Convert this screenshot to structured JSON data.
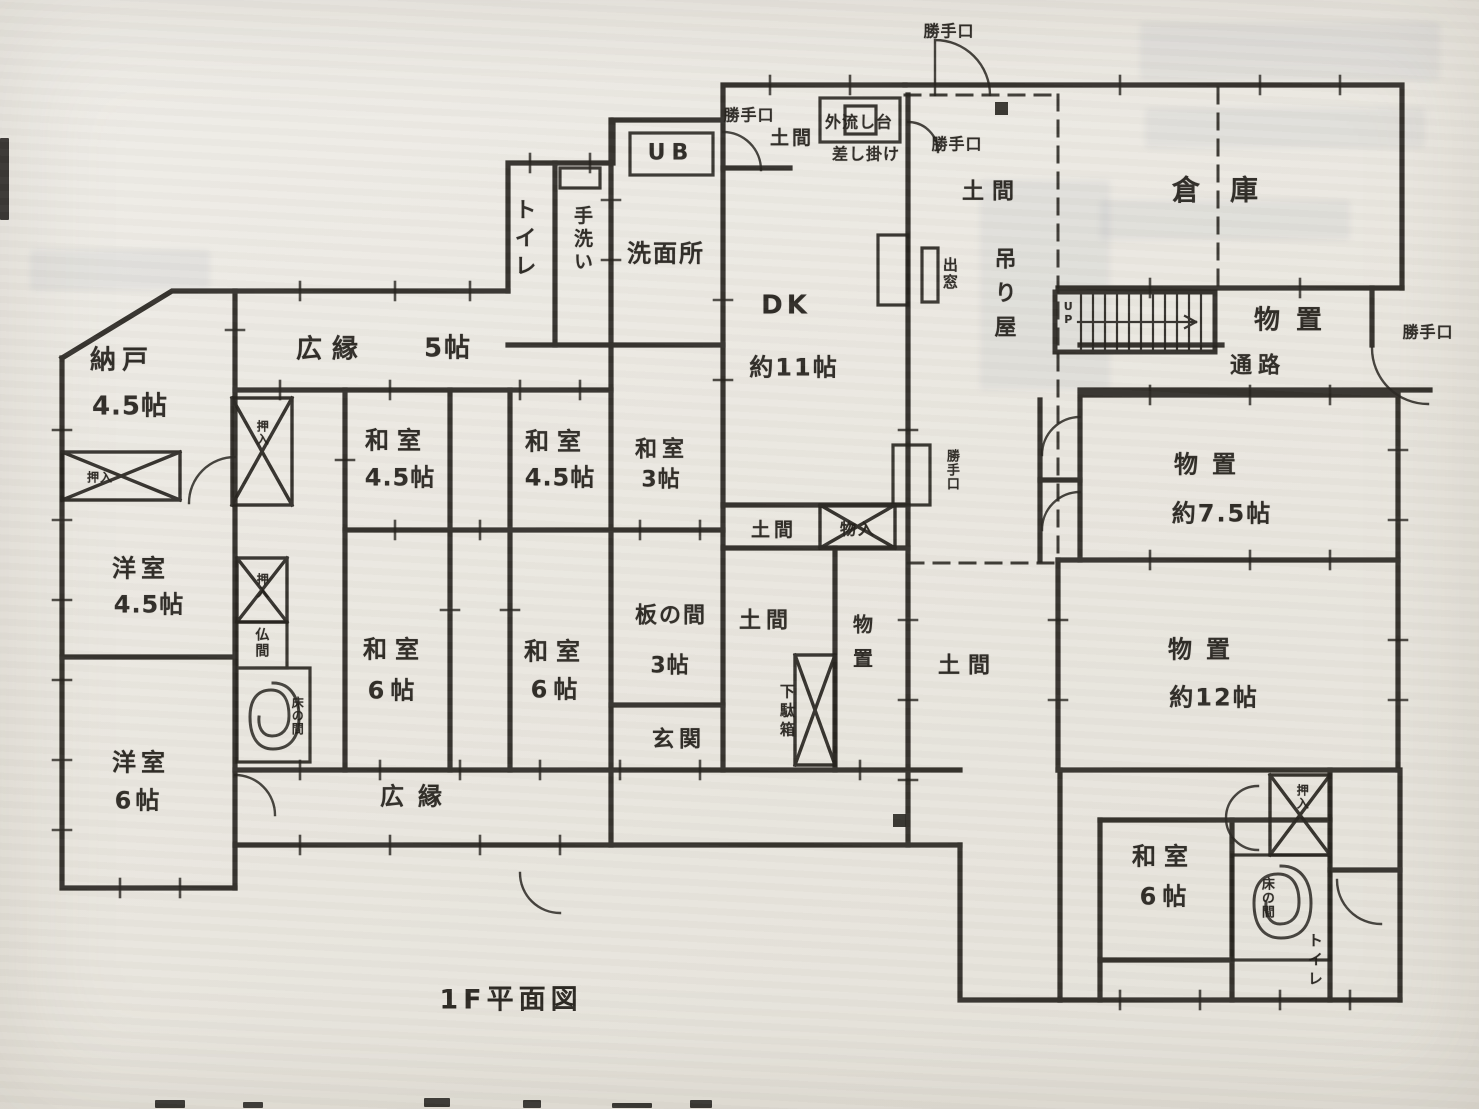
{
  "document": {
    "plan_title": "1F平面図"
  },
  "palette": {
    "paper": "#eae7e0",
    "ink": "#26231e"
  },
  "stairs": {
    "direction_label": "UP"
  },
  "labels": [
    {
      "name": "nando",
      "text": "納戸",
      "x": 122,
      "y": 361,
      "fs": 26,
      "o": "h",
      "ls": 6
    },
    {
      "name": "nando-size",
      "text": "4.5帖",
      "x": 130,
      "y": 407,
      "fs": 26,
      "o": "h",
      "ls": 1
    },
    {
      "name": "hiroen-top",
      "text": "広縁",
      "x": 332,
      "y": 350,
      "fs": 26,
      "o": "h",
      "ls": 10
    },
    {
      "name": "hiroen-top-size",
      "text": "5帖",
      "x": 448,
      "y": 349,
      "fs": 26,
      "o": "h",
      "ls": 2
    },
    {
      "name": "toilet-1",
      "text": "トイレ",
      "x": 523,
      "y": 240,
      "fs": 22,
      "o": "v",
      "ls": 6
    },
    {
      "name": "tearai",
      "text": "手洗い",
      "x": 581,
      "y": 240,
      "fs": 19,
      "o": "v",
      "ls": 4
    },
    {
      "name": "ub",
      "text": "UB",
      "x": 671,
      "y": 153,
      "fs": 22,
      "o": "h",
      "ls": 6
    },
    {
      "name": "senmenjo",
      "text": "洗面所",
      "x": 666,
      "y": 254,
      "fs": 24,
      "o": "h",
      "ls": 2
    },
    {
      "name": "katteguchi-1",
      "text": "勝手口",
      "x": 749,
      "y": 116,
      "fs": 16,
      "o": "h",
      "ls": 1
    },
    {
      "name": "doma-kitchen",
      "text": "土間",
      "x": 792,
      "y": 139,
      "fs": 19,
      "o": "h",
      "ls": 3
    },
    {
      "name": "sotonagashidai",
      "text": "外流し台",
      "x": 859,
      "y": 123,
      "fs": 16,
      "o": "h",
      "ls": 1
    },
    {
      "name": "sashikake",
      "text": "差し掛け",
      "x": 866,
      "y": 155,
      "fs": 16,
      "o": "h",
      "ls": 1
    },
    {
      "name": "katteguchi-2",
      "text": "勝手口",
      "x": 949,
      "y": 32,
      "fs": 16,
      "o": "h",
      "ls": 1
    },
    {
      "name": "katteguchi-3",
      "text": "勝手口",
      "x": 957,
      "y": 145,
      "fs": 16,
      "o": "h",
      "ls": 1
    },
    {
      "name": "doma-top",
      "text": "土間",
      "x": 992,
      "y": 192,
      "fs": 22,
      "o": "h",
      "ls": 8
    },
    {
      "name": "tsuriya",
      "text": "吊り屋",
      "x": 1003,
      "y": 298,
      "fs": 22,
      "o": "v",
      "ls": 12
    },
    {
      "name": "demado",
      "text": "出窓",
      "x": 949,
      "y": 274,
      "fs": 15,
      "o": "v",
      "ls": 2
    },
    {
      "name": "dk",
      "text": "DK",
      "x": 786,
      "y": 306,
      "fs": 26,
      "o": "h",
      "ls": 4
    },
    {
      "name": "dk-size",
      "text": "約11帖",
      "x": 794,
      "y": 368,
      "fs": 24,
      "o": "h",
      "ls": 2
    },
    {
      "name": "souko",
      "text": "倉庫",
      "x": 1230,
      "y": 190,
      "fs": 28,
      "o": "h",
      "ls": 30
    },
    {
      "name": "monooki-1",
      "text": "物置",
      "x": 1296,
      "y": 321,
      "fs": 26,
      "o": "h",
      "ls": 16
    },
    {
      "name": "tsuuro",
      "text": "通路",
      "x": 1258,
      "y": 366,
      "fs": 22,
      "o": "h",
      "ls": 6
    },
    {
      "name": "katteguchi-4",
      "text": "勝手口",
      "x": 1428,
      "y": 333,
      "fs": 16,
      "o": "h",
      "ls": 1
    },
    {
      "name": "monooki-2",
      "text": "物置",
      "x": 1212,
      "y": 465,
      "fs": 24,
      "o": "h",
      "ls": 14
    },
    {
      "name": "monooki-2-size",
      "text": "約7.5帖",
      "x": 1222,
      "y": 514,
      "fs": 24,
      "o": "h",
      "ls": 2
    },
    {
      "name": "washitsu-1",
      "text": "和室",
      "x": 397,
      "y": 441,
      "fs": 24,
      "o": "h",
      "ls": 8
    },
    {
      "name": "washitsu-1-size",
      "text": "4.5帖",
      "x": 400,
      "y": 478,
      "fs": 24,
      "o": "h",
      "ls": 1
    },
    {
      "name": "washitsu-2",
      "text": "和室",
      "x": 557,
      "y": 442,
      "fs": 24,
      "o": "h",
      "ls": 8
    },
    {
      "name": "washitsu-2-size",
      "text": "4.5帖",
      "x": 560,
      "y": 478,
      "fs": 24,
      "o": "h",
      "ls": 1
    },
    {
      "name": "washitsu-3",
      "text": "和室",
      "x": 662,
      "y": 450,
      "fs": 22,
      "o": "h",
      "ls": 5
    },
    {
      "name": "washitsu-3-size",
      "text": "3帖",
      "x": 661,
      "y": 480,
      "fs": 22,
      "o": "h",
      "ls": 1
    },
    {
      "name": "doma-center-1",
      "text": "土間",
      "x": 774,
      "y": 531,
      "fs": 19,
      "o": "h",
      "ls": 4
    },
    {
      "name": "monoire",
      "text": "物入",
      "x": 858,
      "y": 530,
      "fs": 16,
      "o": "h",
      "ls": 2
    },
    {
      "name": "doma-center-2",
      "text": "土間",
      "x": 766,
      "y": 621,
      "fs": 22,
      "o": "h",
      "ls": 5
    },
    {
      "name": "monooki-column",
      "text": "物置",
      "x": 861,
      "y": 648,
      "fs": 20,
      "o": "v",
      "ls": 14
    },
    {
      "name": "getabako",
      "text": "下駄箱",
      "x": 786,
      "y": 712,
      "fs": 15,
      "o": "v",
      "ls": 4
    },
    {
      "name": "doma-center-3",
      "text": "土間",
      "x": 968,
      "y": 666,
      "fs": 22,
      "o": "h",
      "ls": 8
    },
    {
      "name": "itanoma",
      "text": "板の間",
      "x": 671,
      "y": 616,
      "fs": 22,
      "o": "h",
      "ls": 2
    },
    {
      "name": "itanoma-size",
      "text": "3帖",
      "x": 670,
      "y": 666,
      "fs": 22,
      "o": "h",
      "ls": 1
    },
    {
      "name": "genkan",
      "text": "玄関",
      "x": 679,
      "y": 740,
      "fs": 22,
      "o": "h",
      "ls": 5
    },
    {
      "name": "washitsu-4",
      "text": "和室",
      "x": 395,
      "y": 650,
      "fs": 24,
      "o": "h",
      "ls": 8
    },
    {
      "name": "washitsu-4-size",
      "text": "6帖",
      "x": 394,
      "y": 691,
      "fs": 24,
      "o": "h",
      "ls": 6
    },
    {
      "name": "washitsu-5",
      "text": "和室",
      "x": 556,
      "y": 652,
      "fs": 24,
      "o": "h",
      "ls": 8
    },
    {
      "name": "washitsu-5-size",
      "text": "6帖",
      "x": 557,
      "y": 690,
      "fs": 24,
      "o": "h",
      "ls": 6
    },
    {
      "name": "youshitsu-1",
      "text": "洋室",
      "x": 141,
      "y": 569,
      "fs": 24,
      "o": "h",
      "ls": 5
    },
    {
      "name": "youshitsu-1-size",
      "text": "4.5帖",
      "x": 149,
      "y": 605,
      "fs": 24,
      "o": "h",
      "ls": 1
    },
    {
      "name": "youshitsu-2",
      "text": "洋室",
      "x": 141,
      "y": 763,
      "fs": 24,
      "o": "h",
      "ls": 5
    },
    {
      "name": "youshitsu-2-size",
      "text": "6帖",
      "x": 139,
      "y": 801,
      "fs": 24,
      "o": "h",
      "ls": 4
    },
    {
      "name": "hiroen-bottom",
      "text": "広縁",
      "x": 418,
      "y": 797,
      "fs": 24,
      "o": "h",
      "ls": 14
    },
    {
      "name": "monooki-3",
      "text": "物置",
      "x": 1206,
      "y": 650,
      "fs": 24,
      "o": "h",
      "ls": 14
    },
    {
      "name": "monooki-3-size",
      "text": "約12帖",
      "x": 1214,
      "y": 698,
      "fs": 24,
      "o": "h",
      "ls": 2
    },
    {
      "name": "washitsu-6",
      "text": "和室",
      "x": 1164,
      "y": 857,
      "fs": 24,
      "o": "h",
      "ls": 8
    },
    {
      "name": "washitsu-6-size",
      "text": "6帖",
      "x": 1166,
      "y": 897,
      "fs": 24,
      "o": "h",
      "ls": 6
    },
    {
      "name": "tokonoma-2",
      "text": "床の間",
      "x": 1266,
      "y": 898,
      "fs": 13,
      "o": "v",
      "ls": 1
    },
    {
      "name": "oshiire-4",
      "text": "押入",
      "x": 1302,
      "y": 797,
      "fs": 12,
      "o": "v",
      "ls": 1
    },
    {
      "name": "toilet-2",
      "text": "トイレ",
      "x": 1314,
      "y": 961,
      "fs": 15,
      "o": "v",
      "ls": 4
    },
    {
      "name": "oshiire-1",
      "text": "押入",
      "x": 262,
      "y": 433,
      "fs": 12,
      "o": "v",
      "ls": 1
    },
    {
      "name": "oshiire-2",
      "text": "押入",
      "x": 100,
      "y": 478,
      "fs": 12,
      "o": "h",
      "ls": 1
    },
    {
      "name": "oshiire-3",
      "text": "押入",
      "x": 262,
      "y": 586,
      "fs": 12,
      "o": "v",
      "ls": 1
    },
    {
      "name": "butsuma",
      "text": "仏間",
      "x": 261,
      "y": 643,
      "fs": 14,
      "o": "v",
      "ls": 2
    },
    {
      "name": "tokonoma-1",
      "text": "床の間",
      "x": 297,
      "y": 716,
      "fs": 12,
      "o": "v",
      "ls": 1
    },
    {
      "name": "katteguchi-5",
      "text": "勝手口",
      "x": 951,
      "y": 470,
      "fs": 13,
      "o": "v",
      "ls": 1
    },
    {
      "name": "up",
      "text": "UP",
      "x": 1068,
      "y": 313,
      "fs": 11,
      "o": "v",
      "ls": 0
    }
  ]
}
